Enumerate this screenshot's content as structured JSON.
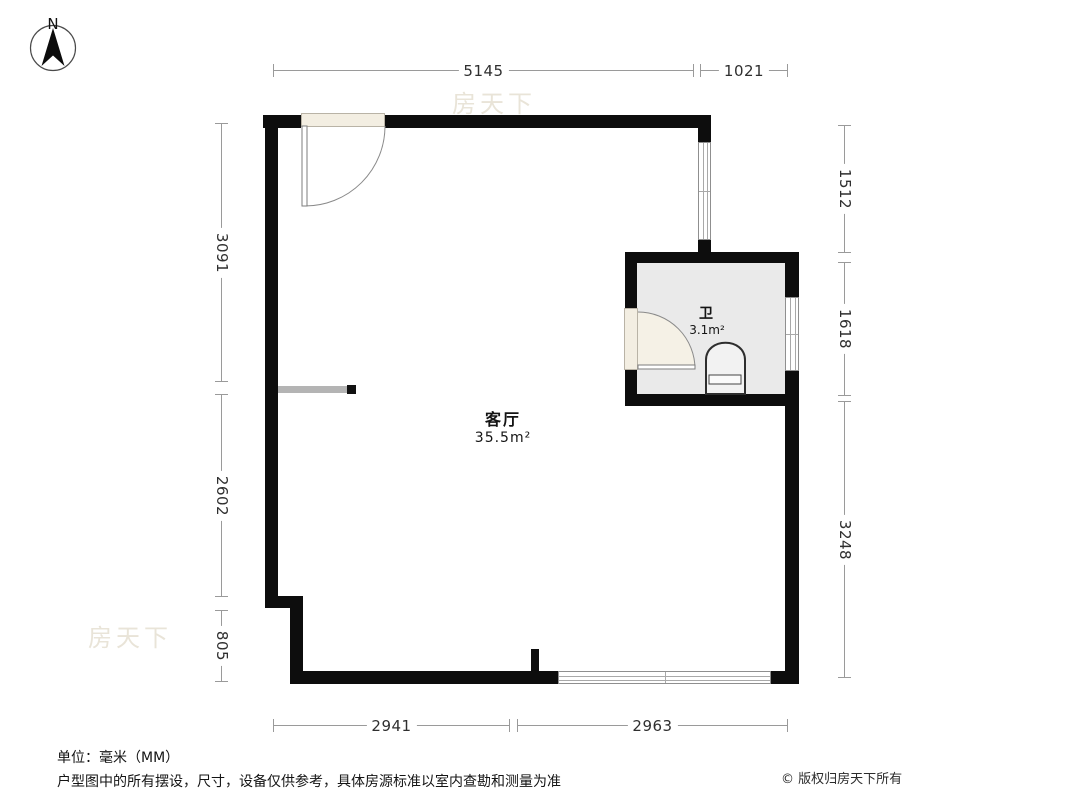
{
  "compass": {
    "label": "N"
  },
  "rooms": {
    "living": {
      "name": "客厅",
      "area": "35.5m²"
    },
    "bath": {
      "name": "卫",
      "area": "3.1m²"
    }
  },
  "dimensions": {
    "top": [
      "5145",
      "1021"
    ],
    "bottom": [
      "2941",
      "2963"
    ],
    "left": [
      "3091",
      "2602",
      "805"
    ],
    "right": [
      "1512",
      "1618",
      "3248"
    ]
  },
  "footer": {
    "unit": "单位：毫米（MM）",
    "disclaimer": "户型图中的所有摆设，尺寸，设备仅供参考，具体房源标准以室内查勘和测量为准",
    "copyright": "© 版权归房天下所有"
  },
  "watermark": "房天下",
  "colors": {
    "wall": "#0d0d0d",
    "bath_floor": "#eaeaea",
    "door_fill": "#f3eee2",
    "dim_line": "#9a9a9a",
    "dim_text": "#2f2f2f"
  }
}
